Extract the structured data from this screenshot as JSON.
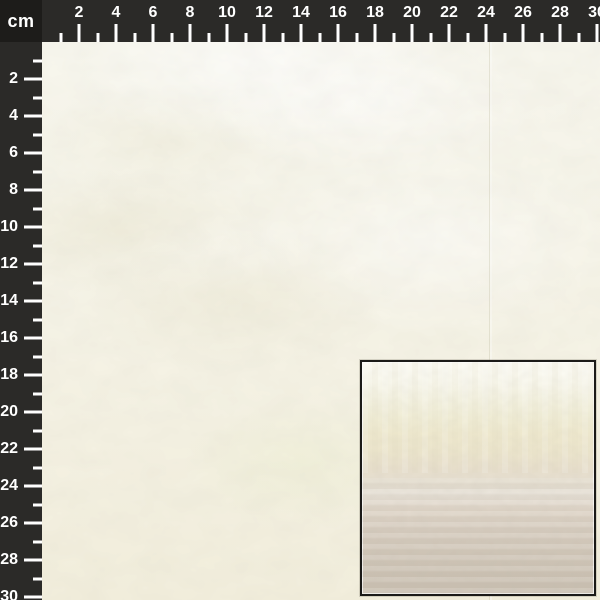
{
  "ruler": {
    "unit_label": "cm",
    "max_cm": 30,
    "horizontal_labels": [
      "2",
      "4",
      "6",
      "8",
      "10",
      "12",
      "14",
      "16",
      "18",
      "20",
      "22",
      "24",
      "26",
      "28",
      "30"
    ],
    "vertical_labels": [
      "2",
      "4",
      "6",
      "8",
      "10",
      "12",
      "14",
      "16",
      "18",
      "20",
      "22",
      "24",
      "26",
      "28",
      "30"
    ],
    "colors": {
      "band": "#2b2a28",
      "corner": "#1d1c1a",
      "tick": "#ffffff"
    }
  },
  "specimen": {
    "colors": {
      "top": "#f8f7ee",
      "bottom": "#f3efdd",
      "highlight": "#fdfdf8",
      "shadow": "#edead6",
      "green_tint": "#eef0d8",
      "seam": "#b8b298"
    }
  },
  "inset": {
    "border_color": "#1b1a18",
    "gradient_stops": [
      {
        "color": "#fdfcf5",
        "at": 0
      },
      {
        "color": "#faf9ee",
        "at": 9
      },
      {
        "color": "#f5f3e2",
        "at": 16
      },
      {
        "color": "#f2efd8",
        "at": 23
      },
      {
        "color": "#f0eacf",
        "at": 31
      },
      {
        "color": "#ede6cd",
        "at": 39
      },
      {
        "color": "#e9e0cd",
        "at": 46
      },
      {
        "color": "#e7e0d2",
        "at": 52
      },
      {
        "color": "#e9e3d9",
        "at": 57
      },
      {
        "color": "#e1d7ca",
        "at": 64
      },
      {
        "color": "#d9cfc2",
        "at": 72
      },
      {
        "color": "#d3c9bb",
        "at": 82
      },
      {
        "color": "#cec4b6",
        "at": 92
      },
      {
        "color": "#ccc2b4",
        "at": 100
      }
    ]
  }
}
